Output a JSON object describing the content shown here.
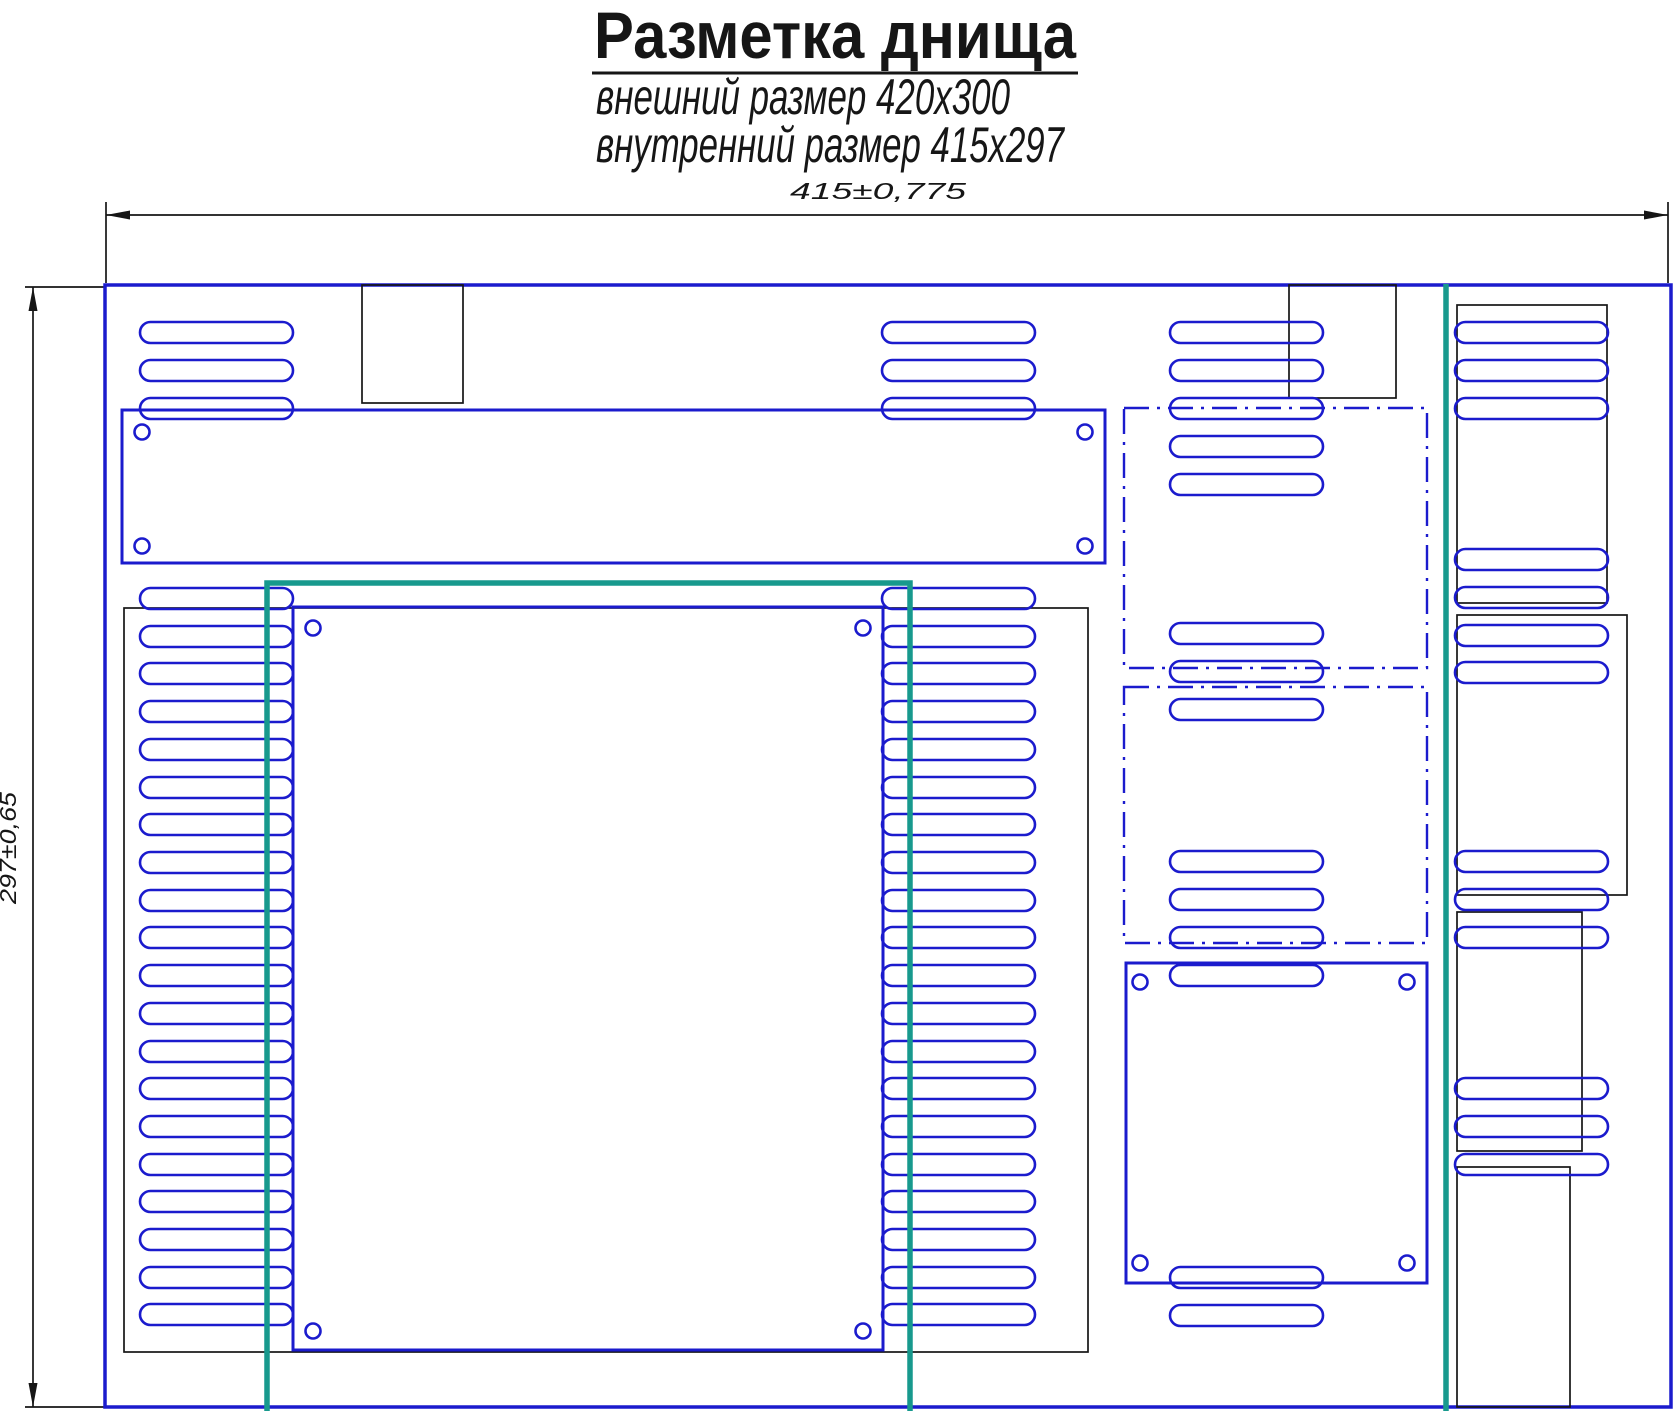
{
  "labels": {
    "title": "Разметка днища",
    "subtitle1": "внешний размер 420x300",
    "subtitle2": "внутренний размер 415x297",
    "dim_width": "415±0,775",
    "dim_height": "297±0,65"
  },
  "colors": {
    "blue": "#1b1bcd",
    "teal": "#17998d",
    "black": "#161616",
    "background": "#ffffff"
  },
  "drawing": {
    "canvas": {
      "w": 1675,
      "h": 1411
    },
    "outer_rect": {
      "x": 105,
      "y": 285,
      "w": 1566,
      "h": 1122
    },
    "dims": {
      "top": {
        "y": 215,
        "x1": 106,
        "x2": 1668,
        "ext": [
          [
            106,
            202,
            106,
            283
          ],
          [
            1668,
            202,
            1668,
            283
          ]
        ],
        "arrows": [
          [
            106,
            215,
            130,
            210.5,
            130,
            219.5
          ],
          [
            1668,
            215,
            1644,
            210.5,
            1644,
            219.5
          ]
        ]
      },
      "left": {
        "x": 33,
        "y1": 287,
        "y2": 1407,
        "ext": [
          [
            25,
            287,
            104,
            287
          ],
          [
            25,
            1407,
            104,
            1407
          ]
        ],
        "arrows": [
          [
            33,
            287,
            28.5,
            311,
            37.5,
            311
          ],
          [
            33,
            1407,
            28.5,
            1383,
            37.5,
            1383
          ]
        ]
      }
    },
    "black_rects": [
      {
        "name": "cutout-top-left",
        "x": 362,
        "y": 285,
        "w": 101,
        "h": 118
      },
      {
        "name": "cutout-top-right",
        "x": 1289,
        "y": 285,
        "w": 107,
        "h": 113
      },
      {
        "name": "inner-outline",
        "x": 124,
        "y": 608,
        "w": 964,
        "h": 744
      },
      {
        "name": "right-outline-upper",
        "x": 1457,
        "y": 305,
        "w": 150,
        "h": 298
      },
      {
        "name": "right-outline-mid",
        "x": 1457,
        "y": 615,
        "w": 170,
        "h": 280
      },
      {
        "name": "right-outline-lower",
        "x": 1457,
        "y": 912,
        "w": 125,
        "h": 239
      },
      {
        "name": "right-outline-bottom",
        "x": 1457,
        "y": 1167,
        "w": 113,
        "h": 240
      }
    ],
    "panels": [
      {
        "name": "top-plate",
        "x": 122,
        "y": 410,
        "w": 983,
        "h": 153,
        "holes": [
          [
            142,
            432
          ],
          [
            1085,
            432
          ],
          [
            142,
            546
          ],
          [
            1085,
            546
          ]
        ]
      },
      {
        "name": "center-plate",
        "x": 293,
        "y": 607,
        "w": 590,
        "h": 743,
        "holes": [
          [
            313,
            628
          ],
          [
            863,
            628
          ],
          [
            313,
            1331
          ],
          [
            863,
            1331
          ]
        ]
      },
      {
        "name": "lower-right-plate",
        "x": 1126,
        "y": 963,
        "w": 301,
        "h": 320,
        "holes": [
          [
            1140,
            982
          ],
          [
            1407,
            982
          ],
          [
            1140,
            1263
          ],
          [
            1407,
            1263
          ]
        ]
      }
    ],
    "hole_radius": 7.5,
    "dashdot_rects": [
      {
        "name": "zone-upper",
        "x": 1124,
        "y": 408,
        "w": 303,
        "h": 260
      },
      {
        "name": "zone-lower",
        "x": 1124,
        "y": 687,
        "w": 303,
        "h": 256
      }
    ],
    "teal": {
      "marking_rect": {
        "x1": 267,
        "y1": 583,
        "x2": 910,
        "y2": 1411
      },
      "marking_line": {
        "x": 1446,
        "y1": 284,
        "y2": 1411
      }
    },
    "slot": {
      "h": 21,
      "rx": 10.5
    },
    "slot_columns": [
      {
        "name": "slots-left",
        "x": 140,
        "w": 153,
        "ys": [
          322,
          360,
          398,
          588,
          626,
          663,
          701,
          739,
          777,
          814,
          852,
          890,
          927,
          965,
          1003,
          1041,
          1078,
          1116,
          1154,
          1191,
          1229,
          1267,
          1304
        ]
      },
      {
        "name": "slots-mid-left",
        "x": 882,
        "w": 153,
        "ys": [
          322,
          360,
          398,
          588,
          626,
          663,
          701,
          739,
          777,
          814,
          852,
          890,
          927,
          965,
          1003,
          1041,
          1078,
          1116,
          1154,
          1191,
          1229,
          1267,
          1304
        ]
      },
      {
        "name": "slots-mid-right",
        "x": 1170,
        "w": 153,
        "ys": [
          322,
          360,
          398,
          436,
          474,
          623,
          661,
          699,
          851,
          889,
          927,
          965,
          1267,
          1305
        ]
      },
      {
        "name": "slots-right",
        "x": 1455,
        "w": 153,
        "ys": [
          322,
          360,
          398,
          549,
          587,
          625,
          662,
          851,
          889,
          927,
          1078,
          1116,
          1154
        ]
      }
    ],
    "strokes": {
      "outer": 3.5,
      "panel": 3,
      "slot": 2.6,
      "dashdot": 2.4,
      "black": 1.7,
      "teal": 5.5,
      "dim": 1.7
    },
    "dashdot_pattern": "25 8 3 8"
  }
}
